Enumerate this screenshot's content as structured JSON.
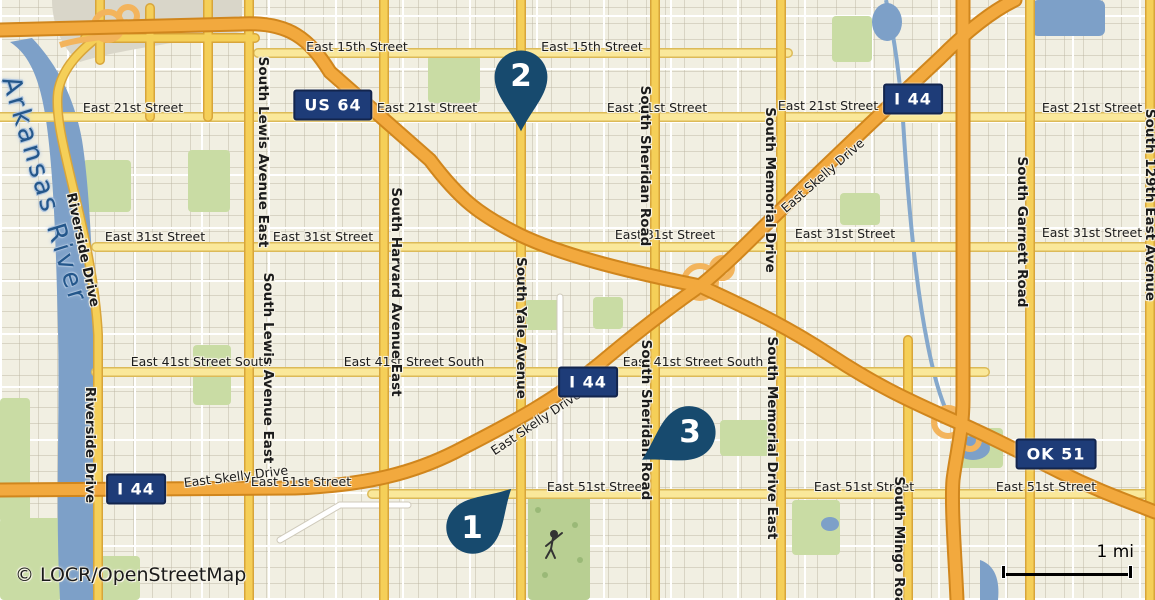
{
  "map": {
    "attribution": "© LOCR/OpenStreetMap",
    "scale_bar": {
      "label": "1 mi"
    },
    "colors": {
      "marker": "#174a6e",
      "shield_bg": "#1e3c78",
      "motorway": "#f2a93e",
      "arterial_yellow": "#f5cf58",
      "street_yellow": "#fae89a",
      "water": "#7da0c8",
      "land": "#f1efe2",
      "park_green": "#c9dca4"
    },
    "markers": [
      {
        "label": "1",
        "x": 472,
        "y": 528,
        "rot": -135
      },
      {
        "label": "2",
        "x": 521,
        "y": 76,
        "rot": 0
      },
      {
        "label": "3",
        "x": 690,
        "y": 432,
        "rot": 60
      }
    ],
    "shields": [
      {
        "text": "US 64",
        "x": 333,
        "y": 105
      },
      {
        "text": "I 44",
        "x": 913,
        "y": 99
      },
      {
        "text": "I 44",
        "x": 588,
        "y": 382
      },
      {
        "text": "I 44",
        "x": 136,
        "y": 489
      },
      {
        "text": "OK 51",
        "x": 1056,
        "y": 454
      }
    ],
    "labels": [
      {
        "text": "East 15th Street",
        "x": 357,
        "y": 47,
        "rot": 0,
        "cls": "street"
      },
      {
        "text": "East 15th Street",
        "x": 592,
        "y": 47,
        "rot": 0,
        "cls": "street"
      },
      {
        "text": "East 21st Street",
        "x": 133,
        "y": 108,
        "rot": 0,
        "cls": "street"
      },
      {
        "text": "East 21st Street",
        "x": 427,
        "y": 108,
        "rot": 0,
        "cls": "street"
      },
      {
        "text": "East 21st Street",
        "x": 657,
        "y": 108,
        "rot": 0,
        "cls": "street"
      },
      {
        "text": "East 21st Street",
        "x": 828,
        "y": 106,
        "rot": 0,
        "cls": "street"
      },
      {
        "text": "East 21st Street",
        "x": 1092,
        "y": 108,
        "rot": 0,
        "cls": "street"
      },
      {
        "text": "East 31st Street",
        "x": 155,
        "y": 237,
        "rot": 0,
        "cls": "street"
      },
      {
        "text": "East 31st Street",
        "x": 323,
        "y": 237,
        "rot": 0,
        "cls": "street"
      },
      {
        "text": "East 31st Street",
        "x": 665,
        "y": 235,
        "rot": 0,
        "cls": "street"
      },
      {
        "text": "East 31st Street",
        "x": 845,
        "y": 234,
        "rot": 0,
        "cls": "street"
      },
      {
        "text": "East 31st Street",
        "x": 1092,
        "y": 233,
        "rot": 0,
        "cls": "street"
      },
      {
        "text": "East 41st Street South",
        "x": 201,
        "y": 362,
        "rot": 0,
        "cls": "street"
      },
      {
        "text": "East 41st Street South",
        "x": 414,
        "y": 362,
        "rot": 0,
        "cls": "street"
      },
      {
        "text": "East 41st Street South",
        "x": 693,
        "y": 362,
        "rot": 0,
        "cls": "street"
      },
      {
        "text": "East 51st Street",
        "x": 301,
        "y": 482,
        "rot": 0,
        "cls": "street"
      },
      {
        "text": "East 51st Street",
        "x": 597,
        "y": 487,
        "rot": 0,
        "cls": "street"
      },
      {
        "text": "East 51st Street",
        "x": 864,
        "y": 487,
        "rot": 0,
        "cls": "street"
      },
      {
        "text": "East 51st Street",
        "x": 1046,
        "y": 487,
        "rot": 0,
        "cls": "street"
      },
      {
        "text": "East Skelly Drive",
        "x": 236,
        "y": 477,
        "rot": -7,
        "cls": "street"
      },
      {
        "text": "East Skelly Drive",
        "x": 536,
        "y": 423,
        "rot": -34,
        "cls": "street"
      },
      {
        "text": "East Skelly Drive",
        "x": 823,
        "y": 176,
        "rot": -41,
        "cls": "street"
      },
      {
        "text": "Riverside Drive",
        "x": 82,
        "y": 250,
        "rot": 78,
        "cls": "avenue"
      },
      {
        "text": "Riverside Drive",
        "x": 89,
        "y": 445,
        "rot": 90,
        "cls": "avenue"
      },
      {
        "text": "South Lewis Avenue East",
        "x": 262,
        "y": 152,
        "rot": 90,
        "cls": "avenue"
      },
      {
        "text": "South Lewis Avenue East",
        "x": 267,
        "y": 368,
        "rot": 90,
        "cls": "avenue"
      },
      {
        "text": "South Harvard Avenue East",
        "x": 395,
        "y": 292,
        "rot": 90,
        "cls": "avenue"
      },
      {
        "text": "South Yale Avenue",
        "x": 520,
        "y": 328,
        "rot": 90,
        "cls": "avenue"
      },
      {
        "text": "South Sheridan Road",
        "x": 644,
        "y": 166,
        "rot": 90,
        "cls": "avenue"
      },
      {
        "text": "South Sheridan Road",
        "x": 645,
        "y": 420,
        "rot": 90,
        "cls": "avenue"
      },
      {
        "text": "South Memorial Drive",
        "x": 769,
        "y": 190,
        "rot": 90,
        "cls": "avenue"
      },
      {
        "text": "South Memorial Drive East",
        "x": 771,
        "y": 438,
        "rot": 90,
        "cls": "avenue"
      },
      {
        "text": "South Mingo Road",
        "x": 898,
        "y": 546,
        "rot": 90,
        "cls": "avenue"
      },
      {
        "text": "South Garnett Road",
        "x": 1021,
        "y": 232,
        "rot": 90,
        "cls": "avenue"
      },
      {
        "text": "South 129th East Avenue",
        "x": 1149,
        "y": 205,
        "rot": 90,
        "cls": "avenue"
      },
      {
        "text": "Arkansas River",
        "x": 44,
        "y": 190,
        "rot": 73,
        "cls": "river"
      }
    ]
  }
}
